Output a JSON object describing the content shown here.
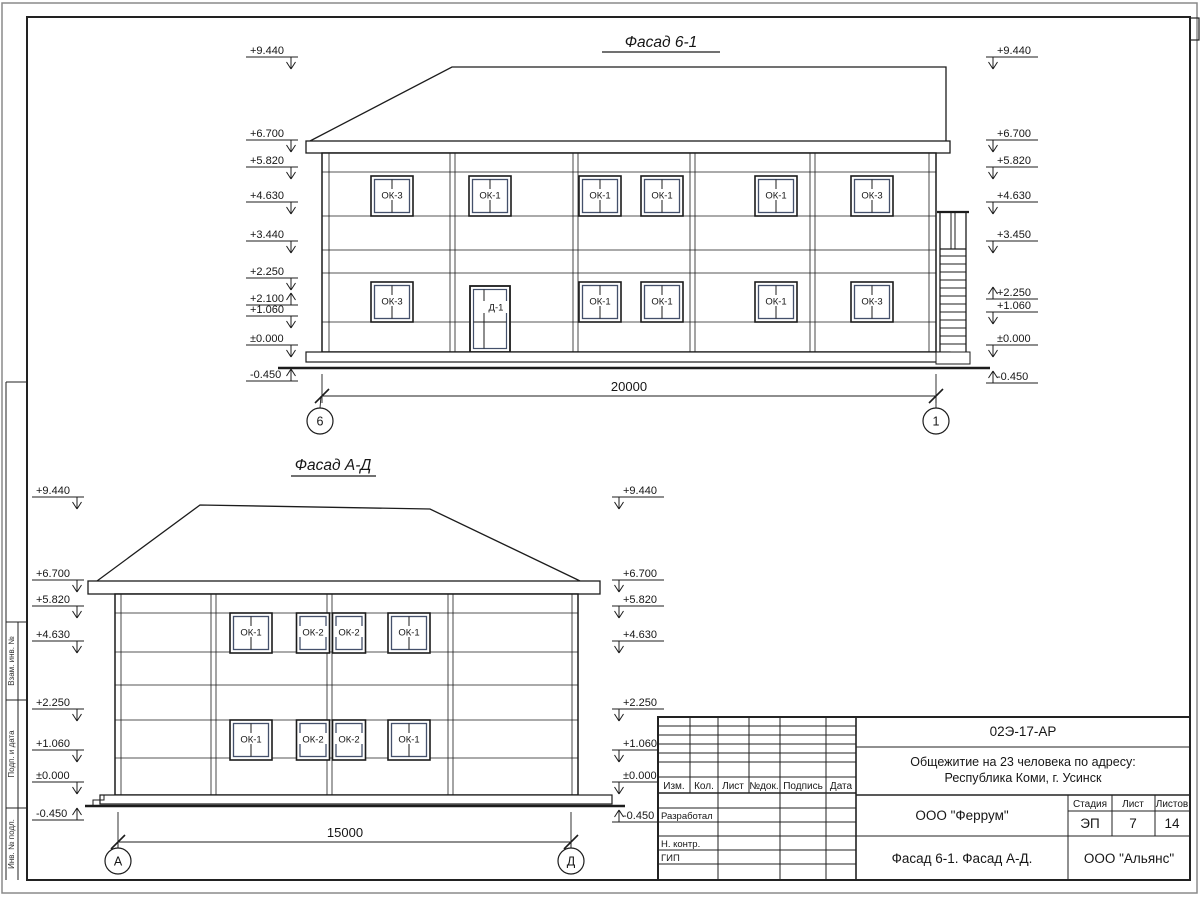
{
  "facade1": {
    "title": "Фасад 6-1",
    "dimension": "20000",
    "axis_left": "6",
    "axis_right": "1",
    "door_label": "Д-1",
    "windows": [
      {
        "l": "ОК-3",
        "x": 392,
        "y": 176
      },
      {
        "l": "ОК-1",
        "x": 490,
        "y": 176
      },
      {
        "l": "ОК-1",
        "x": 600,
        "y": 176
      },
      {
        "l": "ОК-1",
        "x": 662,
        "y": 176
      },
      {
        "l": "ОК-1",
        "x": 776,
        "y": 176
      },
      {
        "l": "ОК-3",
        "x": 872,
        "y": 176
      },
      {
        "l": "ОК-3",
        "x": 392,
        "y": 282
      },
      {
        "l": "ОК-1",
        "x": 600,
        "y": 282
      },
      {
        "l": "ОК-1",
        "x": 662,
        "y": 282
      },
      {
        "l": "ОК-1",
        "x": 776,
        "y": 282
      },
      {
        "l": "ОК-3",
        "x": 872,
        "y": 282
      }
    ],
    "marks_left": [
      {
        "v": "+9.440",
        "y": 57,
        "a": "d"
      },
      {
        "v": "+6.700",
        "y": 140,
        "a": "d"
      },
      {
        "v": "+5.820",
        "y": 167,
        "a": "d"
      },
      {
        "v": "+4.630",
        "y": 202,
        "a": "d"
      },
      {
        "v": "+3.440",
        "y": 241,
        "a": "d"
      },
      {
        "v": "+2.250",
        "y": 278,
        "a": "d"
      },
      {
        "v": "+2.100",
        "y": 305,
        "a": "u"
      },
      {
        "v": "+1.060",
        "y": 316,
        "a": "d"
      },
      {
        "v": "±0.000",
        "y": 345,
        "a": "d"
      },
      {
        "v": "-0.450",
        "y": 381,
        "a": "u"
      }
    ],
    "marks_right": [
      {
        "v": "+9.440",
        "y": 57,
        "a": "d"
      },
      {
        "v": "+6.700",
        "y": 140,
        "a": "d"
      },
      {
        "v": "+5.820",
        "y": 167,
        "a": "d"
      },
      {
        "v": "+4.630",
        "y": 202,
        "a": "d"
      },
      {
        "v": "+3.450",
        "y": 241,
        "a": "d"
      },
      {
        "v": "+2.250",
        "y": 299,
        "a": "u"
      },
      {
        "v": "+1.060",
        "y": 312,
        "a": "d"
      },
      {
        "v": "±0.000",
        "y": 345,
        "a": "d"
      },
      {
        "v": "-0.450",
        "y": 383,
        "a": "u"
      }
    ],
    "marks_left_cfg": {
      "x1": 246,
      "x2": 298,
      "ax": 291,
      "tx": 250,
      "anchor": "start"
    },
    "marks_right_cfg": {
      "x1": 986,
      "x2": 1038,
      "ax": 993,
      "tx": 997,
      "anchor": "start"
    }
  },
  "facade2": {
    "title": "Фасад А-Д",
    "dimension": "15000",
    "axis_left": "А",
    "axis_right": "Д",
    "windows": [
      {
        "l": "ОК-1",
        "x": 251,
        "y": 613
      },
      {
        "l": "ОК-2",
        "x": 313,
        "y": 613
      },
      {
        "l": "ОК-2",
        "x": 349,
        "y": 613
      },
      {
        "l": "ОК-1",
        "x": 409,
        "y": 613
      },
      {
        "l": "ОК-1",
        "x": 251,
        "y": 720
      },
      {
        "l": "ОК-2",
        "x": 313,
        "y": 720
      },
      {
        "l": "ОК-2",
        "x": 349,
        "y": 720
      },
      {
        "l": "ОК-1",
        "x": 409,
        "y": 720
      }
    ],
    "marks_left": [
      {
        "v": "+9.440",
        "y": 497,
        "a": "d"
      },
      {
        "v": "+6.700",
        "y": 580,
        "a": "d"
      },
      {
        "v": "+5.820",
        "y": 606,
        "a": "d"
      },
      {
        "v": "+4.630",
        "y": 641,
        "a": "d"
      },
      {
        "v": "+2.250",
        "y": 709,
        "a": "d"
      },
      {
        "v": "+1.060",
        "y": 750,
        "a": "d"
      },
      {
        "v": "±0.000",
        "y": 782,
        "a": "d"
      },
      {
        "v": "-0.450",
        "y": 820,
        "a": "u"
      }
    ],
    "marks_right": [
      {
        "v": "+9.440",
        "y": 497,
        "a": "d"
      },
      {
        "v": "+6.700",
        "y": 580,
        "a": "d"
      },
      {
        "v": "+5.820",
        "y": 606,
        "a": "d"
      },
      {
        "v": "+4.630",
        "y": 641,
        "a": "d"
      },
      {
        "v": "+2.250",
        "y": 709,
        "a": "d"
      },
      {
        "v": "+1.060",
        "y": 750,
        "a": "d"
      },
      {
        "v": "±0.000",
        "y": 782,
        "a": "d"
      },
      {
        "v": "-0.450",
        "y": 822,
        "a": "u"
      }
    ],
    "marks_left_cfg": {
      "x1": 32,
      "x2": 84,
      "ax": 77,
      "tx": 36,
      "anchor": "start"
    },
    "marks_right_cfg": {
      "x1": 612,
      "x2": 664,
      "ax": 619,
      "tx": 623,
      "anchor": "start"
    }
  },
  "title_block": {
    "doc_number": "02Э-17-АР",
    "object_line1": "Общежитие на 23 человека по адресу:",
    "object_line2": "Республика Коми, г. Усинск",
    "rev_headers": [
      "Изм.",
      "Кол.",
      "Лист",
      "№док.",
      "Подпись",
      "Дата"
    ],
    "role_rows": [
      "Разработал",
      "Н. контр.",
      "ГИП"
    ],
    "company": "ООО \"Феррум\"",
    "stage_label": "Стадия",
    "sheet_label": "Лист",
    "sheets_label": "Листов",
    "stage": "ЭП",
    "sheet": "7",
    "sheets": "14",
    "drawing_title": "Фасад 6-1. Фасад  А-Д.",
    "contractor": "ООО \"Альянс\""
  },
  "margin_stamps": [
    "Взам. инв. №",
    "Подп. и дата",
    "Инв. № подл."
  ],
  "colors": {
    "line": "#1c1c1c",
    "window_inner": "#44506b",
    "outer_border": "#8a8a8a"
  }
}
